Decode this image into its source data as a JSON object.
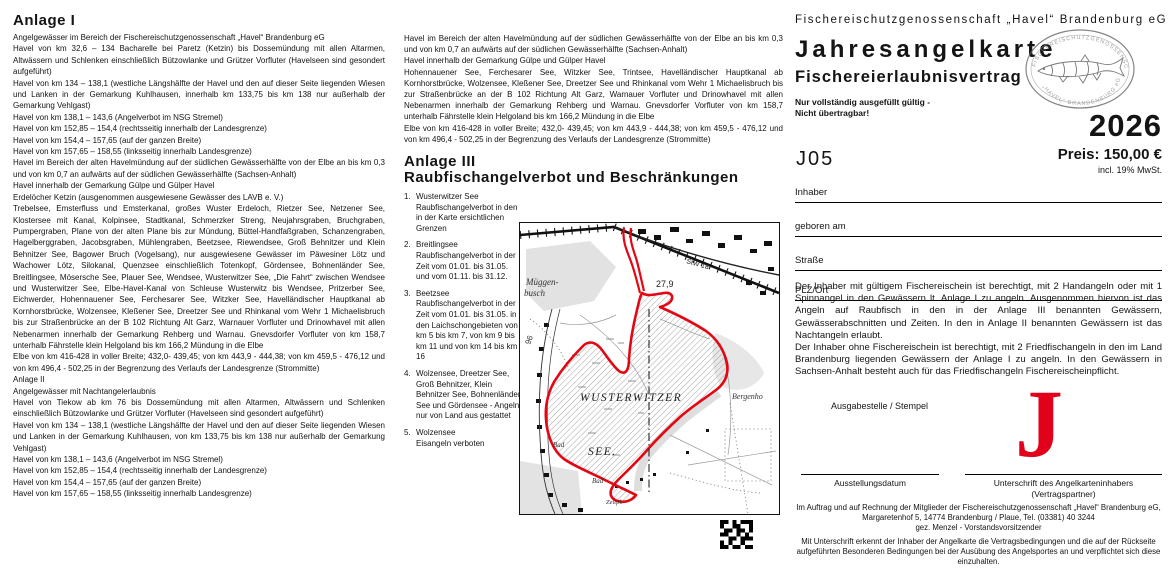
{
  "colors": {
    "accent_red": "#e2001a",
    "map_boundary_red": "#e30613"
  },
  "col1": {
    "heading": "Anlage I",
    "paragraphs": [
      "Angelgewässer im Bereich der Fischereischutzgenossenschaft „Havel“ Brandenburg eG",
      "Havel von km 32,6 –  134 Bacharelle bei Paretz (Ketzin) bis Dossemündung mit allen Altarmen, Altwässern und Schlenken einschließlich Bützowlanke und Grützer Vorfluter (Havelseen sind gesondert aufgeführt)",
      "Havel von km 134 – 138,1 (westliche Längshälfte der Havel und den auf dieser Seite liegenden Wiesen und Lanken in der Gemarkung Kuhlhausen, innerhalb km 133,75 bis km 138 nur außerhalb der Gemarkung Vehlgast)",
      "Havel von km 138,1 – 143,6 (Angelverbot im NSG Stremel)",
      "Havel von km 152,85 – 154,4 (rechtsseitig innerhalb der Landesgrenze)",
      "Havel von km 154,4 – 157,65 (auf der ganzen Breite)",
      "Havel von km 157,65 – 158,55 (linksseitig innerhalb Landesgrenze)",
      "Havel im Bereich der alten Havelmündung auf der südlichen Gewässerhälfte von der Elbe an bis km 0,3 und von km 0,7 an aufwärts auf der südlichen Gewässerhälfte (Sachsen-Anhalt)",
      "Havel innerhalb der Gemarkung Gülpe und Gülper Havel",
      "Erdelöcher Ketzin (ausgenommen ausgewiesene Gewässer des LAVB e. V.)",
      "Trebelsee, Emsterfluss und Emsterkanal, großes Wuster Erdeloch, Rietzer See, Netzener See, Klostersee mit Kanal, Kolpinsee, Stadtkanal, Schmerzker Streng, Neujahrsgraben, Bruchgraben, Pumpergraben, Plane von der alten Plane bis zur Mündung, Büttel-Handfaßgraben, Schanzengraben, Hagelberggraben, Jacobsgraben, Mühlengraben, Beetzsee, Riewendsee, Groß Behnitzer und Klein Behnitzer See, Bagower Bruch (Vogelsang), nur ausgewiesene Gewässer im Päwesiner Lötz und Wachower Lötz, Silokanal, Quenzsee einschließlich Totenkopf, Gördensee, Bohnenländer See, Breitlingsee, Mösersche See, Plauer See, Wendsee, Wusterwitzer See, „Die Fahrt“ zwischen Wendsee und Wusterwitzer See, Elbe-Havel-Kanal von Schleuse Wusterwitz bis Wendsee, Pritzerber See, Eichwerder, Hohennauener See, Ferchesarer See, Witzker See, Havelländischer Hauptkanal ab Kornhorstbrücke, Wolzensee, Kleßener See, Dreetzer See und Rhinkanal vom Wehr 1 Michaelisbruch bis zur Straßenbrücke an der B 102 Richtung Alt Garz, Warnauer Vorfluter und Drinowhavel mit allen Nebenarmen innerhalb der Gemarkung Rehberg und Warnau. Gnevsdorfer Vorfluter von km 158,7 unterhalb Fährstelle klein Helgoland bis km 166,2 Mündung in die Elbe",
      "Elbe von km 416-428 in voller Breite; 432,0- 439,45; von km 443,9 - 444,38; von km 459,5 - 476,12 und von km 496,4 - 502,25 in der Begrenzung des Verlaufs der Landesgrenze (Strommitte)",
      "Anlage II",
      "Angelgewässer mit Nachtangelerlaubnis",
      "Havel von Tiekow ab km 76 bis Dossemündung mit allen Altarmen, Altwässern und Schlenken einschließlich Bützowlanke und Grützer Vorfluter (Havelseen sind gesondert aufgeführt)",
      "Havel von km 134 – 138,1 (westliche Längshälfte der Havel und den auf dieser Seite liegenden Wiesen und Lanken in der Gemarkung Kuhlhausen, von km 133,75 bis km 138 nur außerhalb der Gemarkung Vehlgast)",
      "Havel von km 138,1 – 143,6 (Angelverbot im NSG Stremel)",
      "Havel von km 152,85 – 154,4 (rechtsseitig innerhalb der Landesgrenze)",
      "Havel von km 154,4 – 157,65 (auf der ganzen Breite)",
      "Havel von km 157,65 – 158,55 (linksseitig innerhalb Landesgrenze)"
    ]
  },
  "col2": {
    "paragraphs": [
      "Havel im Bereich der alten Havelmündung auf der südlichen Gewässerhälfte von der Elbe an bis km 0,3 und von km 0,7 an aufwärts auf der südlichen Gewässerhälfte (Sachsen-Anhalt)",
      "Havel innerhalb der Gemarkung Gülpe und Gülper Havel",
      "Hohennauener See, Ferchesarer See, Witzker See, Trintsee, Havelländischer Hauptkanal ab Kornhorstbrücke, Wolzensee, Kleßener See, Dreetzer See und Rhinkanal vom Wehr 1 Michaelisbruch bis zur Straßenbrücke an der B 102 Richtung Alt Garz, Warnauer Vorfluter und Drinowhavel mit allen Nebenarmen innerhalb der Gemarkung Rehberg und Warnau. Gnevsdorfer Vorfluter von km 158,7 unterhalb Fährstelle klein Helgoland bis km 166,2 Mündung in die Elbe",
      "Elbe von km 416-428 in voller Breite; 432,0- 439,45; von km 443,9 - 444,38; von km 459,5 - 476,12 und von km 496,4 - 502,25 in der Begrenzung des Verlaufs der Landesgrenze (Strommitte)"
    ],
    "anlage3_heading": "Anlage III",
    "anlage3_subtitle": "Raubfischangelverbot und Beschränkungen",
    "items": [
      {
        "num": "1.",
        "text": "Wusterwitzer See\nRaubfischangelverbot in den in der Karte ersichtlichen Grenzen"
      },
      {
        "num": "2.",
        "text": "Breitlingsee\nRaubfischangelverbot in der Zeit vom 01.01. bis 31.05. und vom 01.11. bis 31.12."
      },
      {
        "num": "3.",
        "text": "Beetzsee\nRaubfischangelverbot in der Zeit vom 01.01. bis 31.05. in den Laichschongebieten von km 5 bis km 7, von km 9 bis km 11 und von km 14 bis km 16"
      },
      {
        "num": "4.",
        "text": "Wolzensee, Dreetzer See, Groß Behnitzer, Klein Behnitzer See, Bohnenländer See und Gördensee - Angeln nur von Land aus gestattet"
      },
      {
        "num": "5.",
        "text": "Wolzensee\nEisangeln verboten"
      }
    ]
  },
  "map": {
    "labels": {
      "muggen1": "Müggen-",
      "muggen2": "busch",
      "depth": "27,9",
      "stw": "StW 18",
      "num96": "96",
      "lake1": "WUSTERWITZER",
      "lake2": "SEE.",
      "bad1": "Bad",
      "bad2": "Bad",
      "zelt": "Zeltpl.",
      "bergenhof": "Bergenho"
    }
  },
  "col3": {
    "org": "Fischereischutzgenossenschaft  „Havel“  Brandenburg  eG",
    "title": "Jahresangelkarte",
    "subtitle": "Fischereierlaubnisvertrag",
    "note1": "Nur vollständig ausgefüllt gültig -",
    "note2": "Nicht übertragbar!",
    "year": "2026",
    "code": "J05",
    "price": "Preis: 150,00 €",
    "vat": "incl. 19% MwSt.",
    "fields": [
      "Inhaber",
      "geboren am",
      "Straße",
      "PLZ/Ort"
    ],
    "para1": "Der Inhaber mit gültigem Fischereischein ist berechtigt, mit 2 Handangeln oder mit 1 Spinnangel in den Gewässern lt. Anlage I zu angeln. Ausgenommen hiervon ist das Angeln auf Raubfisch in den in der Anlage III benannten Gewässern, Gewässerabschnitten und Zeiten. In den in Anlage II benannten Gewässern ist das Nachtangeln erlaubt.",
    "para2": "Der Inhaber ohne Fischereischein ist berechtigt, mit 2 Friedfischangeln in den im Land Brandenburg liegenden Gewässern der Anlage I zu angeln. In den Gewässern in Sachsen-Anhalt besteht auch für das Friedfischangeln Fischereischeinpflicht.",
    "stamp_label": "Ausgabestelle / Stempel",
    "big_letter": "J",
    "sig_date_label": "Ausstellungsdatum",
    "sig_holder_label": "Unterschrift des Angelkarteninhabers",
    "sig_holder_sub": "(Vertragspartner)",
    "footer1": "Im Auftrag und auf Rechnung der Mitglieder der Fischereischutzgenossenschaft „Havel“ Brandenburg eG, Margaretenhof 5, 14774 Brandenburg / Plaue, Tel. (03381) 40 3244",
    "footer2": "gez. Menzel - Vorstandsvorsitzender",
    "footer3": "Mit Unterschrift erkennt der Inhaber der Angelkarte die Vertragsbedingungen und die auf der Rückseite aufgeführten Besonderen Bedingungen bei der Ausübung des Angelsportes an und verpflichtet sich diese einzuhalten.",
    "logo_arc_top": "FISCHEREISCHUTZGENOSSENSCHAFT",
    "logo_arc_bottom": "„HAVEL“ BRANDENBURG eG"
  }
}
